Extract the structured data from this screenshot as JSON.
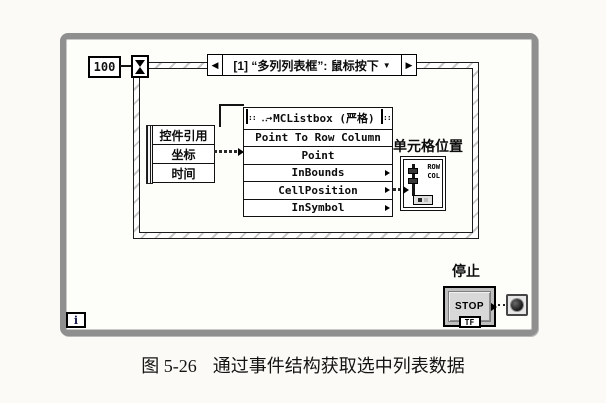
{
  "figure": {
    "caption_number": "图 5-26",
    "caption_text": "通过事件结构获取选中列表数据"
  },
  "diagram": {
    "wait_constant": "100",
    "event_structure": {
      "selector_label": "[1] “多列列表框”: 鼠标按下",
      "event_data_fields": [
        "控件引用",
        "坐标",
        "时间"
      ]
    },
    "invoke_node": {
      "title": "MCListbox (严格)",
      "rows": [
        {
          "label": "Point To Row Column"
        },
        {
          "label": "Point"
        },
        {
          "label": "InBounds"
        },
        {
          "label": "CellPosition"
        },
        {
          "label": "InSymbol"
        }
      ]
    },
    "cell_position_indicator": {
      "label": "单元格位置",
      "row_text": "ROW",
      "col_text": "COL"
    },
    "stop": {
      "label": "停止",
      "button_text": "STOP",
      "type_text": "TF"
    },
    "iteration_terminal": "i"
  },
  "icons": {
    "prev_event": "◀",
    "next_event": "▶",
    "dropdown": "▼",
    "method_arrow": "‥→",
    "corner_dots": "::"
  },
  "colors": {
    "loop_frame": "#8f8f8f",
    "wire": "#141414",
    "paper": "#fbfaf6",
    "button_face": "#d8d8d8"
  }
}
